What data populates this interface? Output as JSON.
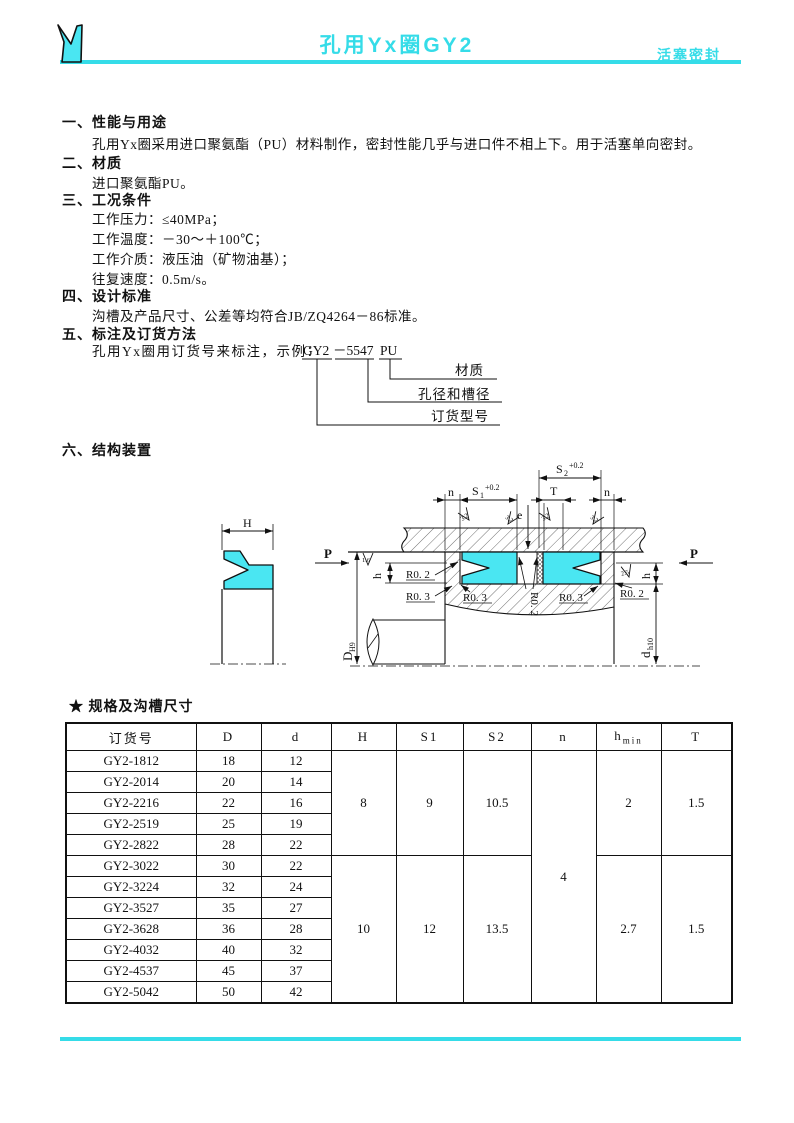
{
  "accent": "#35dce8",
  "seal_fill": "#4ae6f2",
  "header": {
    "title": "孔用Yx圈GY2",
    "tag": "活塞密封"
  },
  "sections": [
    {
      "no": "一、",
      "title": "性能与用途",
      "lines": [
        "孔用Yx圈采用进口聚氨酯（PU）材料制作，密封性能几乎与进口件不相上下。用于活塞单向密封。"
      ]
    },
    {
      "no": "二、",
      "title": "材质",
      "lines": [
        "进口聚氨酯PU。"
      ]
    },
    {
      "no": "三、",
      "title": "工况条件",
      "lines": [
        "工作压力：≤40MPa；",
        "工作温度：－30～＋100℃；",
        "工作介质：液压油（矿物油基）；",
        "往复速度：0.5m/s。"
      ]
    },
    {
      "no": "四、",
      "title": "设计标准",
      "lines": [
        "沟槽及产品尺寸、公差等均符合JB/ZQ4264－86标准。"
      ]
    },
    {
      "no": "五、",
      "title": "标注及订货方法",
      "lines": []
    },
    {
      "no": "六、",
      "title": "结构装置",
      "lines": []
    }
  ],
  "ordering": {
    "prefix": "孔用Yx圈用订货号来标注，示例：",
    "code_part1": "GY2",
    "code_part2": "－5547",
    "code_part3": "PU",
    "label_material": "材质",
    "label_bore": "孔径和槽径",
    "label_model": "订货型号"
  },
  "diagram": {
    "H": "H",
    "P_left": "P",
    "P_right": "P",
    "n_left": "n",
    "n_right": "n",
    "S1": {
      "base": "S",
      "sub": "1",
      "sup": "+0.2"
    },
    "S2": {
      "base": "S",
      "sub": "2",
      "sup": "+0.2"
    },
    "T": "T",
    "e": "e",
    "D": {
      "base": "D",
      "sub": "H9"
    },
    "d": {
      "base": "d",
      "sub": "h10"
    },
    "h_left": "h",
    "h_right": "h",
    "roughness": {
      "bore": "1.6",
      "groove": "3.2",
      "land": "2.5"
    },
    "radii": {
      "left_top": "R0. 2",
      "left_bottom": "R0. 3",
      "mid_left": "R0. 3",
      "mid_rot": "R0. 2",
      "mid_right": "R0. 3",
      "right": "R0. 2"
    }
  },
  "spec": {
    "caption_star": "★",
    "caption": "规格及沟槽尺寸",
    "headers": {
      "code": "订货号",
      "D": "D",
      "d": "d",
      "H": "H",
      "S1": "S1",
      "S2": "S2",
      "n": "n",
      "hmin_base": "h",
      "hmin_sub": "min",
      "T": "T"
    },
    "rows": [
      {
        "code": "GY2-1812",
        "D": "18",
        "d": "12"
      },
      {
        "code": "GY2-2014",
        "D": "20",
        "d": "14"
      },
      {
        "code": "GY2-2216",
        "D": "22",
        "d": "16"
      },
      {
        "code": "GY2-2519",
        "D": "25",
        "d": "19"
      },
      {
        "code": "GY2-2822",
        "D": "28",
        "d": "22"
      },
      {
        "code": "GY2-3022",
        "D": "30",
        "d": "22"
      },
      {
        "code": "GY2-3224",
        "D": "32",
        "d": "24"
      },
      {
        "code": "GY2-3527",
        "D": "35",
        "d": "27"
      },
      {
        "code": "GY2-3628",
        "D": "36",
        "d": "28"
      },
      {
        "code": "GY2-4032",
        "D": "40",
        "d": "32"
      },
      {
        "code": "GY2-4537",
        "D": "45",
        "d": "37"
      },
      {
        "code": "GY2-5042",
        "D": "50",
        "d": "42"
      }
    ],
    "group1": {
      "H": "8",
      "S1": "9",
      "S2": "10.5",
      "hmin": "2",
      "T": "1.5"
    },
    "group2": {
      "H": "10",
      "S1": "12",
      "S2": "13.5",
      "hmin": "2.7",
      "T": "1.5"
    },
    "n": "4"
  }
}
